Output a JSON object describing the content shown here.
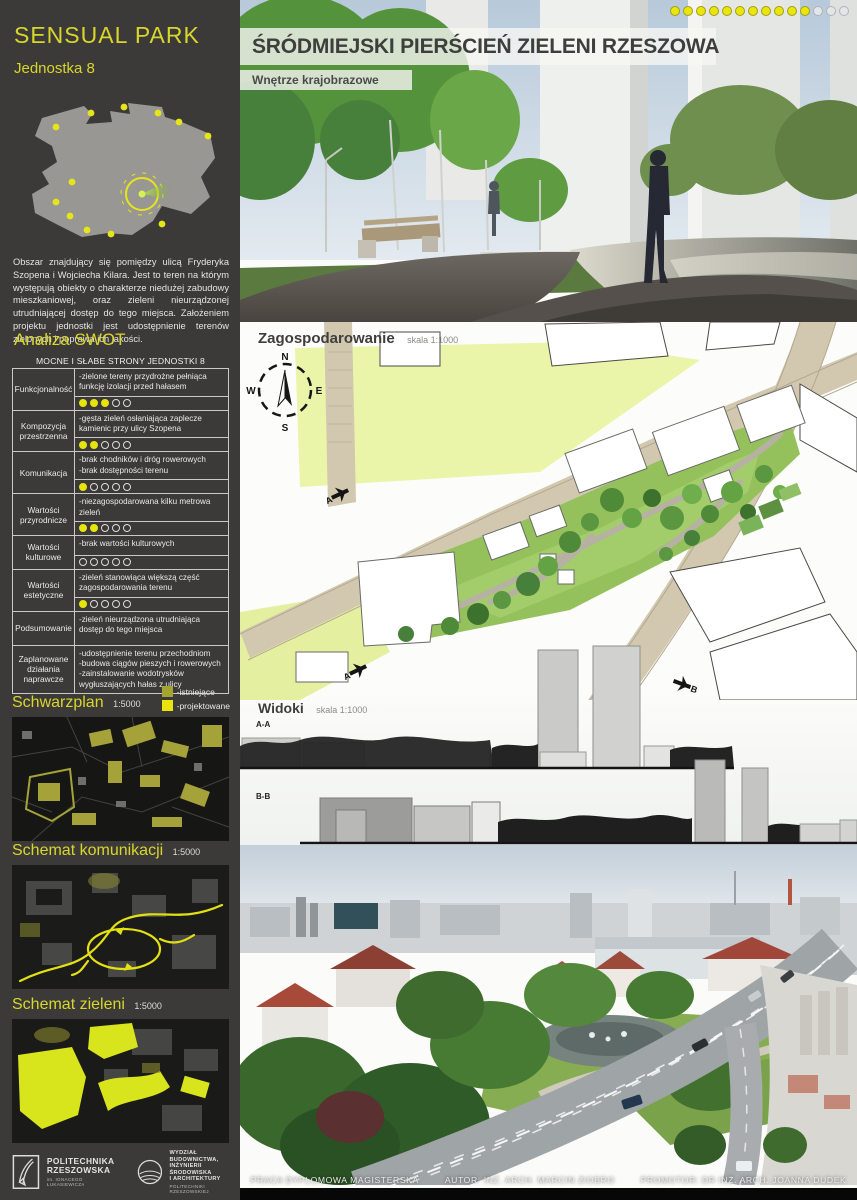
{
  "sidebar": {
    "title": "SENSUAL PARK",
    "subtitle": "Jednostka 8",
    "description": "Obszar znajdujący się pomiędzy ulicą Fryderyka Szopena i Wojciecha Kilara. Jest to teren na którym występują obiekty o charakterze niedużej zabudowy mieszkaniowej, oraz zieleni nieurządzonej utrudniającej dostęp do tego miejsca. Założeniem projektu jednostki jest udostępnienie terenów zielonych i poprawa ich jakości.",
    "swot": {
      "heading": "Analiza SWOT",
      "table_title": "MOCNE I SŁABE STRONY JEDNOSTKI 8",
      "rating_max": 5,
      "rows": [
        {
          "label": "Funkcjonalność",
          "text": "-zielone tereny przydrożne pełniąca funkcję izolacji przed hałasem",
          "score": 3,
          "max": 5
        },
        {
          "label": "Kompozycja przestrzenna",
          "text": "-gęsta zieleń osłaniająca zaplecze kamienic przy ulicy Szopena",
          "score": 2,
          "max": 5
        },
        {
          "label": "Komunikacja",
          "text": "-brak chodników i dróg rowerowych\n-brak dostępności terenu",
          "score": 1,
          "max": 5
        },
        {
          "label": "Wartości przyrodnicze",
          "text": "-niezagospodarowana kilku metrowa zieleń",
          "score": 2,
          "max": 5
        },
        {
          "label": "Wartości kulturowe",
          "text": "-brak wartości  kulturowych",
          "score": 0,
          "max": 5
        },
        {
          "label": "Wartości estetyczne",
          "text": "-zieleń stanowiąca większą część zagospodarowania terenu",
          "score": 1,
          "max": 5
        },
        {
          "label": "Podsumowanie",
          "text": "-zieleń nieurządzona utrudniająca dostęp do tego miejsca",
          "score": null,
          "max": 5
        },
        {
          "label": "Zaplanowane działania naprawcze",
          "text": "-udostępnienie terenu przechodniom\n-budowa ciągów pieszych i rowerowych\n-zainstalowanie wodotrysków wygłuszających hałas z ulicy",
          "score": null,
          "max": 5
        }
      ]
    },
    "legend": [
      {
        "swatch": "olive",
        "label": "-istniejące"
      },
      {
        "swatch": "yellow",
        "label": "-projektowane"
      }
    ],
    "maps": [
      {
        "title": "Schwarzplan",
        "scale": "1:5000"
      },
      {
        "title": "Schemat komunikacji",
        "scale": "1:5000"
      },
      {
        "title": "Schemat zieleni",
        "scale": "1:5000"
      }
    ],
    "logos": [
      {
        "name": "POLITECHNIKA\nRZESZOWSKA",
        "sub": "im. IGNACEGO ŁUKASIEWICZA"
      },
      {
        "name": "WYDZIAŁ\nBUDOWNICTWA,\nINŻYNIERII ŚRODOWISKA\nI ARCHITEKTURY",
        "sub": "POLITECHNIKI RZESZOWSKIEJ"
      }
    ]
  },
  "main": {
    "title": "ŚRÓDMIEJSKI PIERŚCIEŃ ZIELENI RZESZOWA",
    "subtitle": "Wnętrze krajobrazowe",
    "progress_dots": {
      "filled": 11,
      "total": 14
    },
    "plan": {
      "heading": "Zagospodarowanie",
      "scale": "skala 1:1000",
      "compass": {
        "n": "N",
        "e": "E",
        "s": "S",
        "w": "W"
      },
      "markers": [
        "A",
        "B"
      ]
    },
    "views": {
      "heading": "Widoki",
      "scale": "skala 1:1000",
      "sections": [
        "A-A",
        "B-B"
      ]
    },
    "footer": [
      "PRACA DYPLOMOWA MAGISTERSKA",
      "AUTOR: INŻ. ARCH. MARCIN ZIOBRO",
      "PROMOTOR: DR INŻ. ARCH. JOANNA DUDEK"
    ]
  },
  "colors": {
    "accent_yellow": "#d9d62b",
    "legend_existing": "#a6a431",
    "legend_planned": "#e8e40c",
    "sidebar_bg": "#3b3a38"
  }
}
